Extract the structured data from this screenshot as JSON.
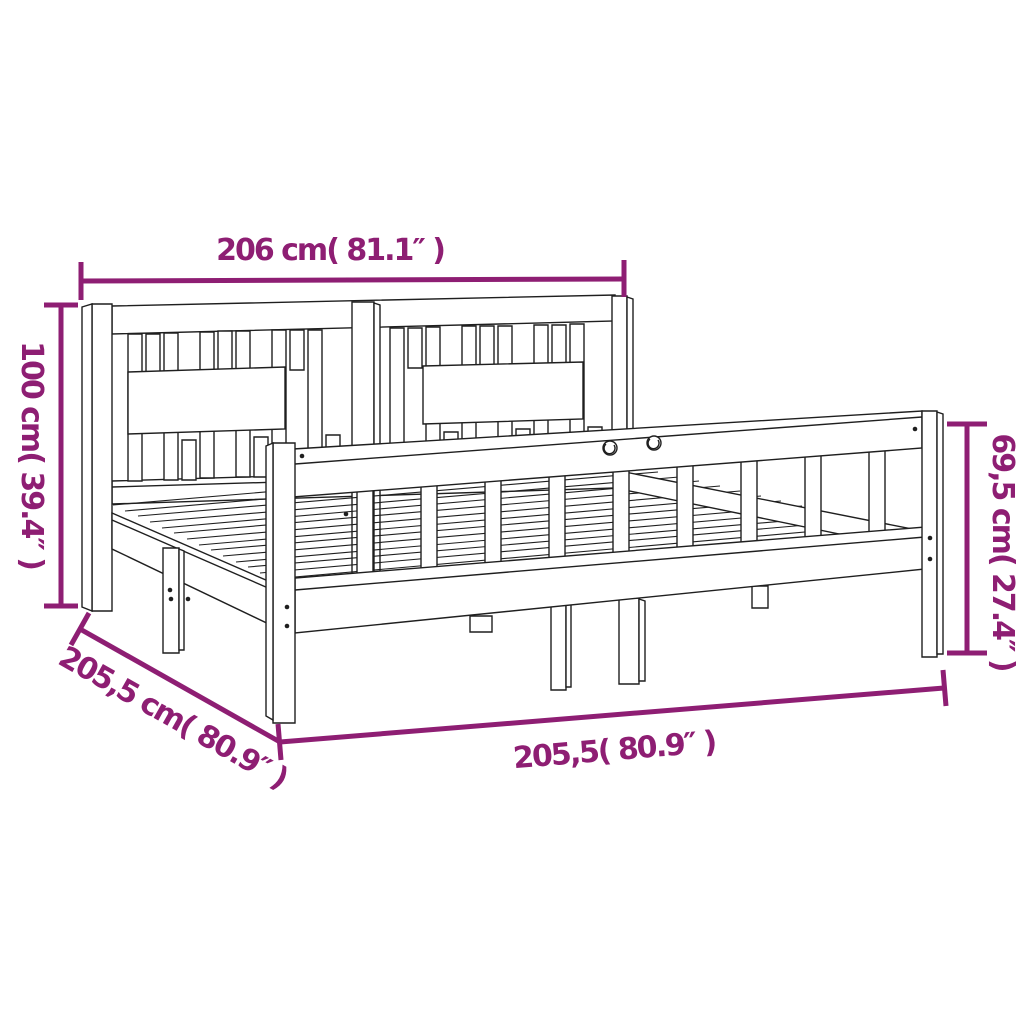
{
  "diagram": {
    "title": "bed-frame-with-headboard-dimension-diagram",
    "style": {
      "accent_color": "#8E1E73",
      "line_color": "#1f1f1f",
      "background": "#ffffff"
    },
    "dimensions": {
      "top_width": {
        "label": "206 cm( 81.1″ )",
        "cm": "206",
        "inches": "81.1"
      },
      "headboard_height": {
        "label": "100 cm( 39.4″ )",
        "cm": "100",
        "inches": "39.4"
      },
      "rail_height": {
        "label": "69,5 cm( 27.4″ )",
        "cm": "69,5",
        "inches": "27.4"
      },
      "frame_depth": {
        "label": "205,5 cm( 80.9″ )",
        "cm": "205,5",
        "inches": "80.9"
      },
      "frame_length": {
        "label": "205,5( 80.9″ )",
        "cm": "205,5",
        "inches": "80.9"
      }
    }
  }
}
